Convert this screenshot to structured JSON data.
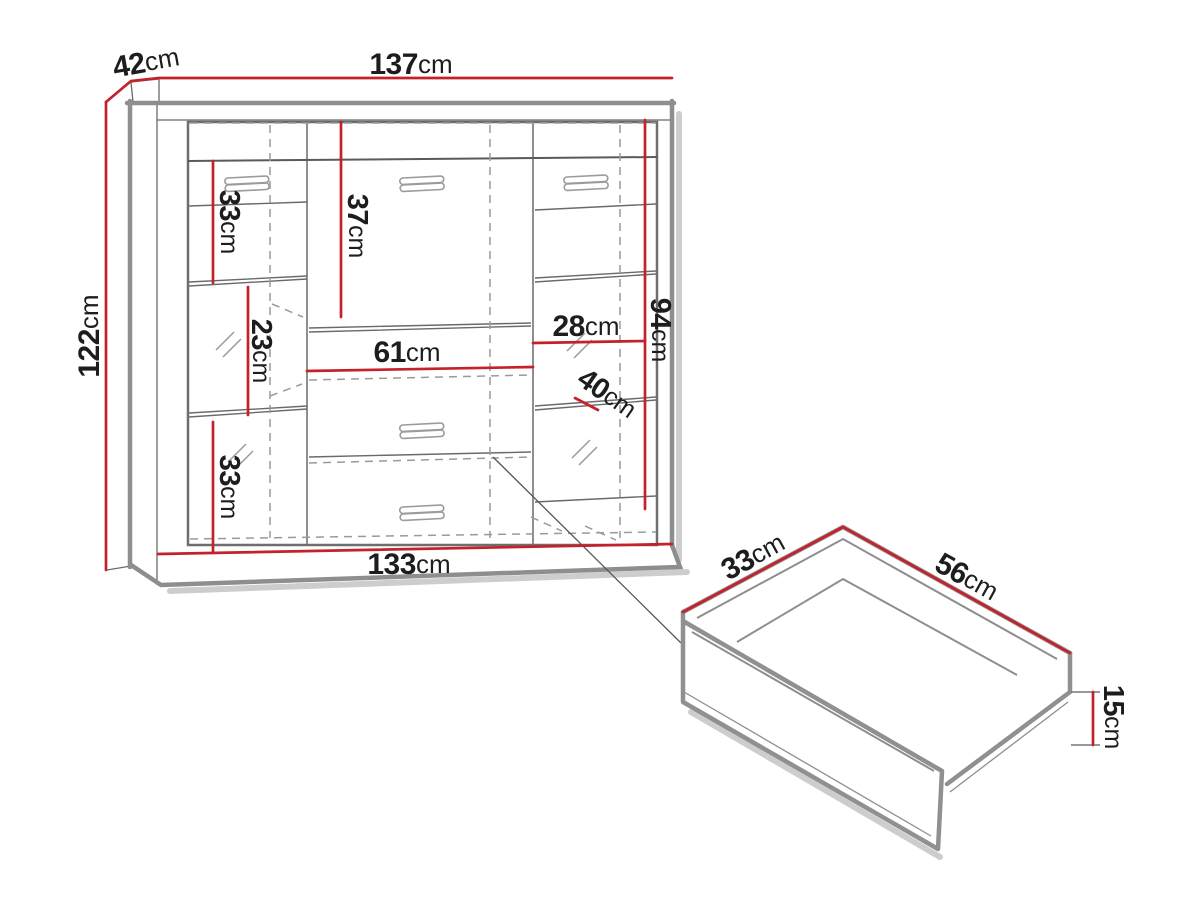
{
  "title": "Cabinet and drawer dimension diagram",
  "colors": {
    "dimension_red": "#c4212a",
    "outline_gray": "#8e8e8e",
    "line_dark": "#5a5a5a",
    "dashed_gray": "#9a9a9a",
    "shadow_gray": "#cdcdcd",
    "text_black": "#1d1d1d"
  },
  "cabinet": {
    "depth": {
      "value": "42",
      "unit": "cm"
    },
    "top_width": {
      "value": "137",
      "unit": "cm"
    },
    "height": {
      "value": "122",
      "unit": "cm"
    },
    "bottom_width": {
      "value": "133",
      "unit": "cm"
    },
    "left_top_section": {
      "value": "33",
      "unit": "cm"
    },
    "left_mid_section": {
      "value": "23",
      "unit": "cm"
    },
    "left_bottom_section": {
      "value": "33",
      "unit": "cm"
    },
    "center_door_height": {
      "value": "37",
      "unit": "cm"
    },
    "center_niche_width": {
      "value": "61",
      "unit": "cm"
    },
    "right_shelf_width": {
      "value": "28",
      "unit": "cm"
    },
    "right_section_height": {
      "value": "94",
      "unit": "cm"
    },
    "right_shelf_depth": {
      "value": "40",
      "unit": "cm"
    }
  },
  "drawer": {
    "depth": {
      "value": "33",
      "unit": "cm"
    },
    "width": {
      "value": "56",
      "unit": "cm"
    },
    "height": {
      "value": "15",
      "unit": "cm"
    }
  }
}
